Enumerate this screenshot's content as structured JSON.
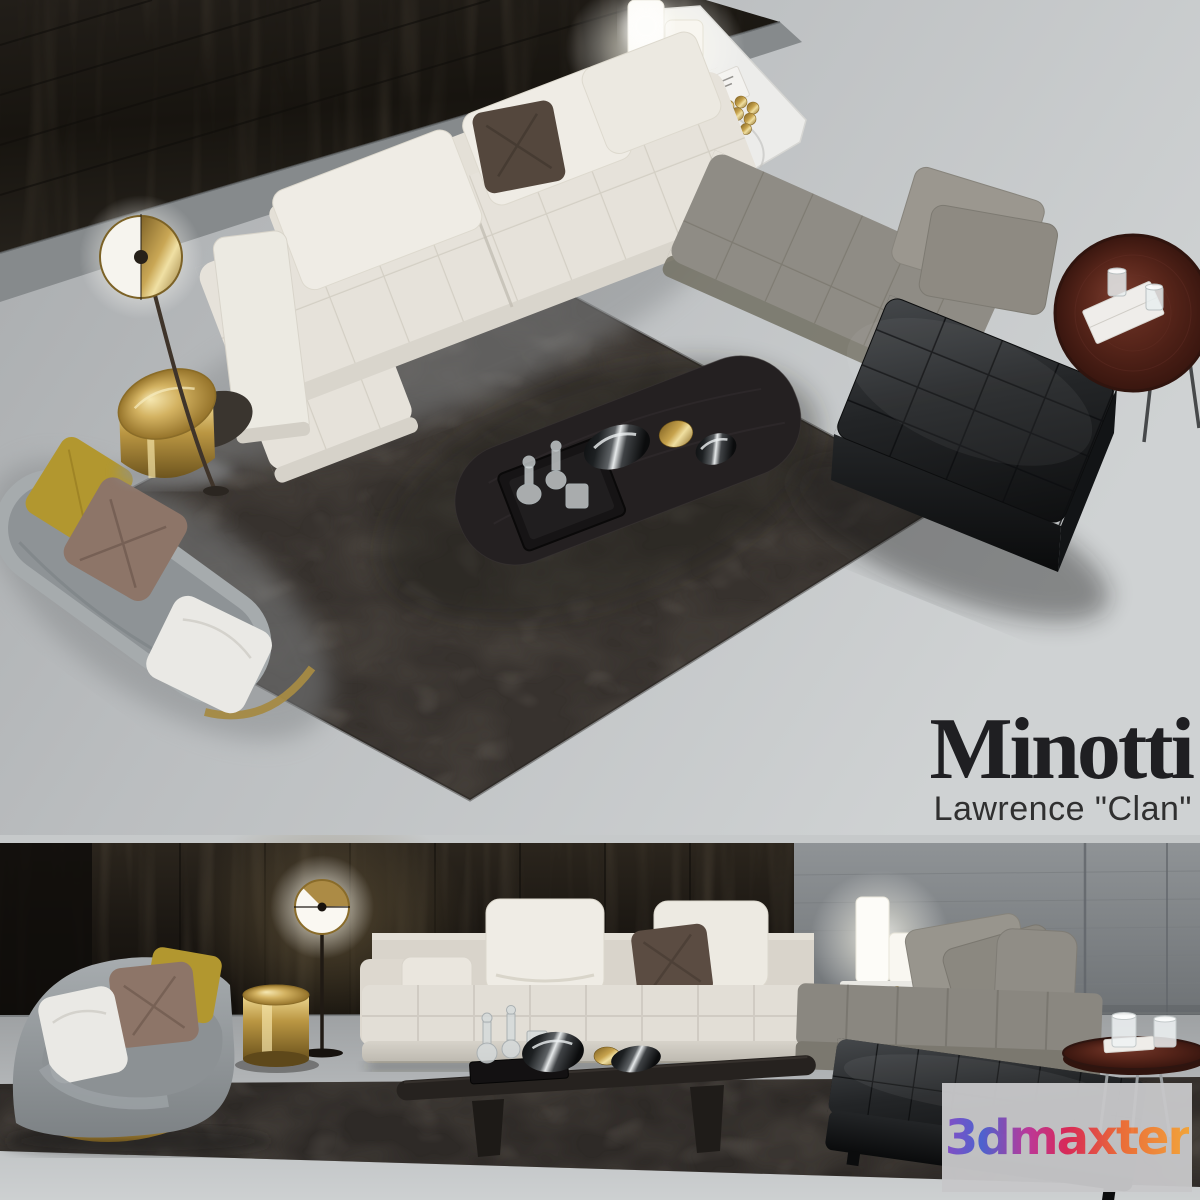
{
  "branding": {
    "logo": "Minotti",
    "collection": "Lawrence \"Clan\""
  },
  "watermark": {
    "text": "3dmaxter"
  },
  "colors": {
    "text_dark": "#1f1f22",
    "text_sub": "#303030",
    "wm_bg": "#c7c7c9",
    "wm_g1": "#8a50cc",
    "wm_g2": "#4f66d6",
    "wm_g3": "#c23a9e",
    "wm_g4": "#e02a5a",
    "wm_g5": "#f3703a",
    "wm_g6": "#f9a83b",
    "sofa_white": "#e6e2da",
    "cushion_white": "#efece5",
    "pillow_brown": "#54473d",
    "sofa_gray": "#8f8c85",
    "sofa_curved": "#a6abad",
    "pillow_mustard": "#b2972f",
    "pillow_taupe": "#8d7568",
    "pillow_white": "#eae9e5",
    "leather_black": "#232527",
    "rug": "#37322e",
    "table_black": "#242021",
    "gold": "#c7a34d",
    "marble": "#ececea",
    "mahogany": "#57251a",
    "floor_light": "#ced1d2",
    "wall_wood": "#1b1712",
    "wall_gray_panel": "#82878a"
  },
  "scene": {
    "top_view": {
      "objects": [
        "white-tufted-sectional-sofa",
        "gray-tufted-chaise",
        "black-leather-ottoman",
        "curved-gray-loveseat",
        "dark-area-rug",
        "black-coffee-table-with-decanters",
        "gold-drum-side-table",
        "brass-disc-floor-lamp",
        "marble-console-with-candles",
        "round-wood-side-table"
      ]
    },
    "front_view": {
      "objects": [
        "curved-gray-loveseat",
        "gold-drum-side-table",
        "brass-disc-floor-lamp",
        "white-tufted-sofa",
        "gray-tufted-chaise",
        "black-leather-bench",
        "black-coffee-table-with-decanters",
        "round-wood-side-table",
        "lit-candles"
      ]
    }
  }
}
